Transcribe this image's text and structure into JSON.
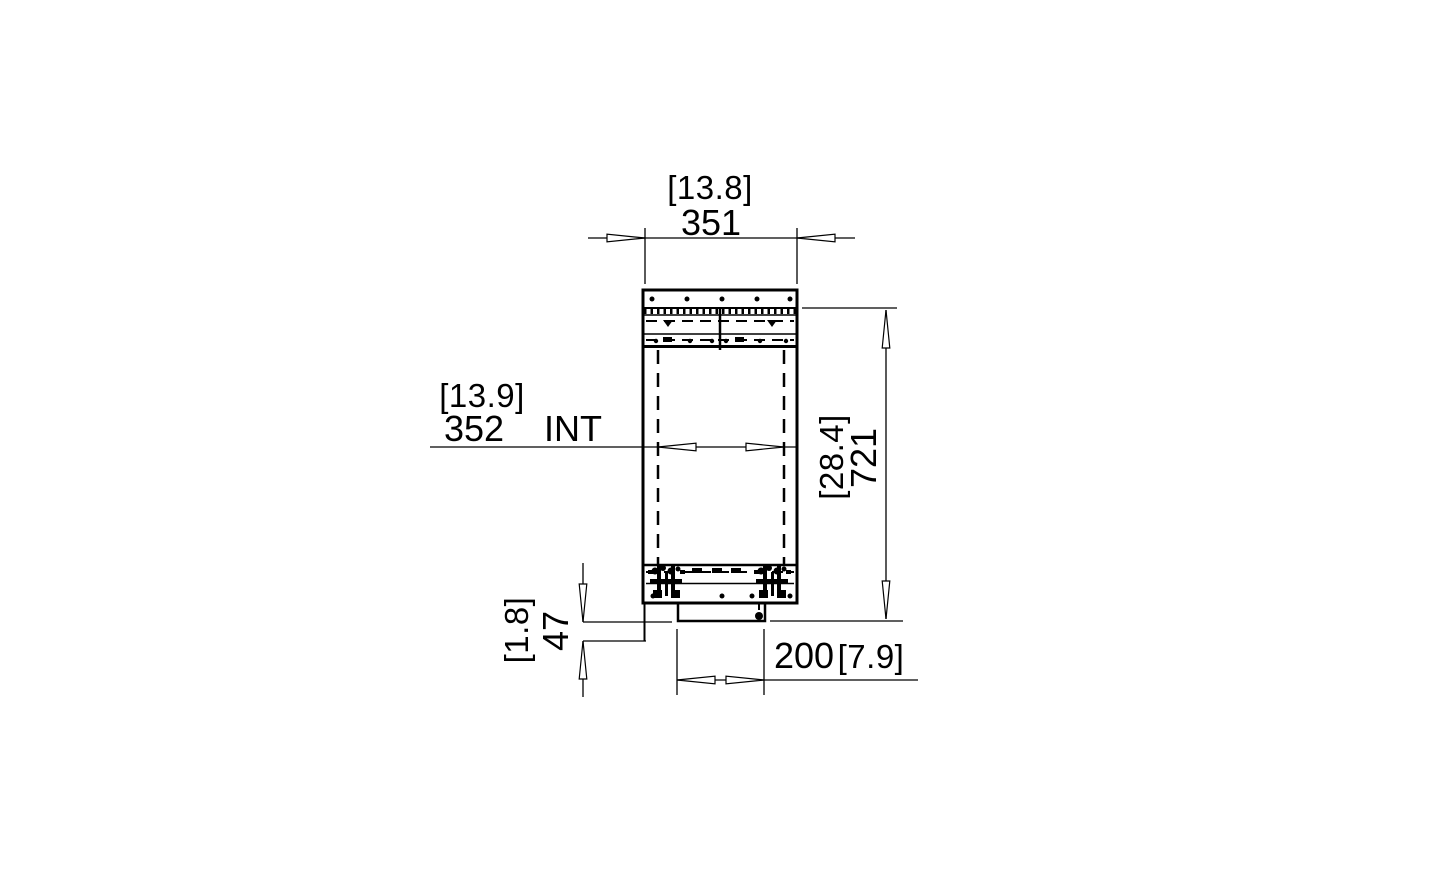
{
  "drawing": {
    "type": "technical-section-view",
    "colors": {
      "line": "#000000",
      "background": "#ffffff"
    },
    "dimensions": {
      "top_width": {
        "imperial": "[13.8]",
        "metric": "351"
      },
      "internal_width": {
        "imperial": "[13.9]",
        "metric": "352",
        "suffix": "INT"
      },
      "height": {
        "imperial": "[28.4]",
        "metric": "721"
      },
      "base_offset": {
        "imperial": "[1.8]",
        "metric": "47"
      },
      "bottom_width": {
        "metric": "200",
        "imperial": "[7.9]"
      }
    }
  }
}
